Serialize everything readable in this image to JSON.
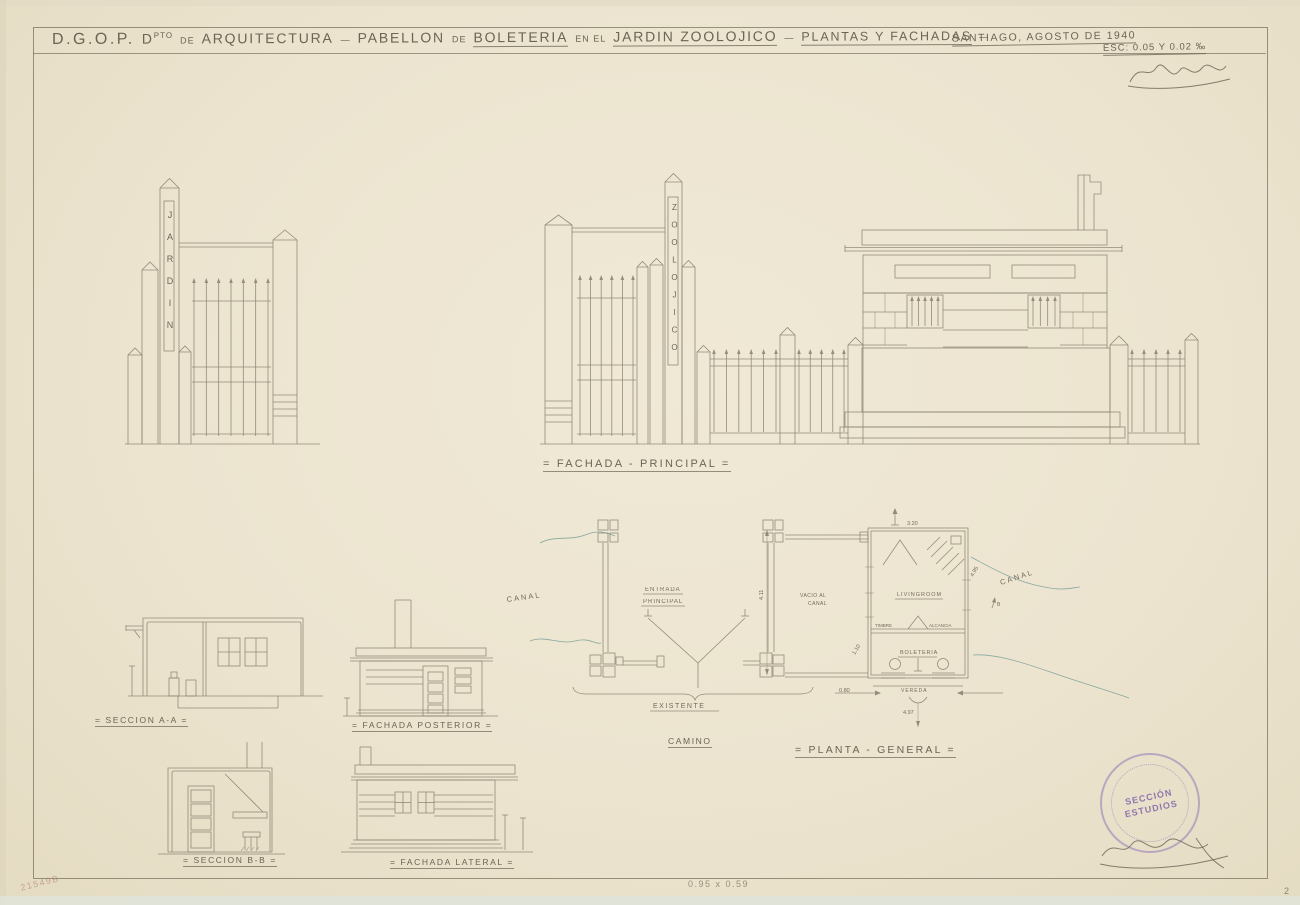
{
  "title": {
    "org": "D.G.O.P.",
    "dept_d": "D",
    "dept_sup": "PTO",
    "de1": "DE",
    "dept_name": "ARQUITECTURA",
    "dash1": "—",
    "pabellon": "PABELLON",
    "de2": "DE",
    "boleteria": "BOLETERIA",
    "en_el": "EN EL",
    "jardin": "JARDIN ZOOLOJICO",
    "dash2": "—",
    "plantas": "PLANTAS Y FACHADAS",
    "dash3": "—",
    "place_date": "SANTIAGO, AGOSTO DE 1940",
    "scale_note": "ESC: 0.05 Y 0.02 ‰"
  },
  "facade": {
    "caption": "= FACHADA - PRINCIPAL =",
    "tower_left": "JARDIN",
    "tower_right": "ZOOLOJICO"
  },
  "drawings": {
    "seccion_a_caption": "= SECCION A-A =",
    "posterior_caption": "= FACHADA POSTERIOR =",
    "seccion_b_caption": "= SECCION B-B =",
    "lateral_caption": "= FACHADA LATERAL ="
  },
  "plan": {
    "caption": "= PLANTA - GENERAL =",
    "canal_left": "CANAL",
    "canal_right": "CANAL",
    "entrada_1": "ENTRADA",
    "entrada_2": "PRINCIPAL",
    "vacio_1": "VACIO AL",
    "vacio_2": "CANAL",
    "existente": "EXISTENTE",
    "camino": "CAMINO",
    "room_main": "LIVINGROOM",
    "room_boleteria": "BOLETERIA",
    "timbre": "TIMBRE",
    "alcancia": "ALCANCIA",
    "vereda": "VEREDA",
    "marker_b": "B",
    "dim_top": "3.20",
    "dim_right": "4.95",
    "dim_gate": "4.11",
    "dim_left": "1.10",
    "dim_small": "0.80",
    "dim_bottom": "4.97"
  },
  "stamp": {
    "line1": "SECCIÓN",
    "line2": "ESTUDIOS"
  },
  "footer": {
    "paper_size": "0.95 x 0.59",
    "archive_mark": "21549B",
    "page_number": "2"
  }
}
